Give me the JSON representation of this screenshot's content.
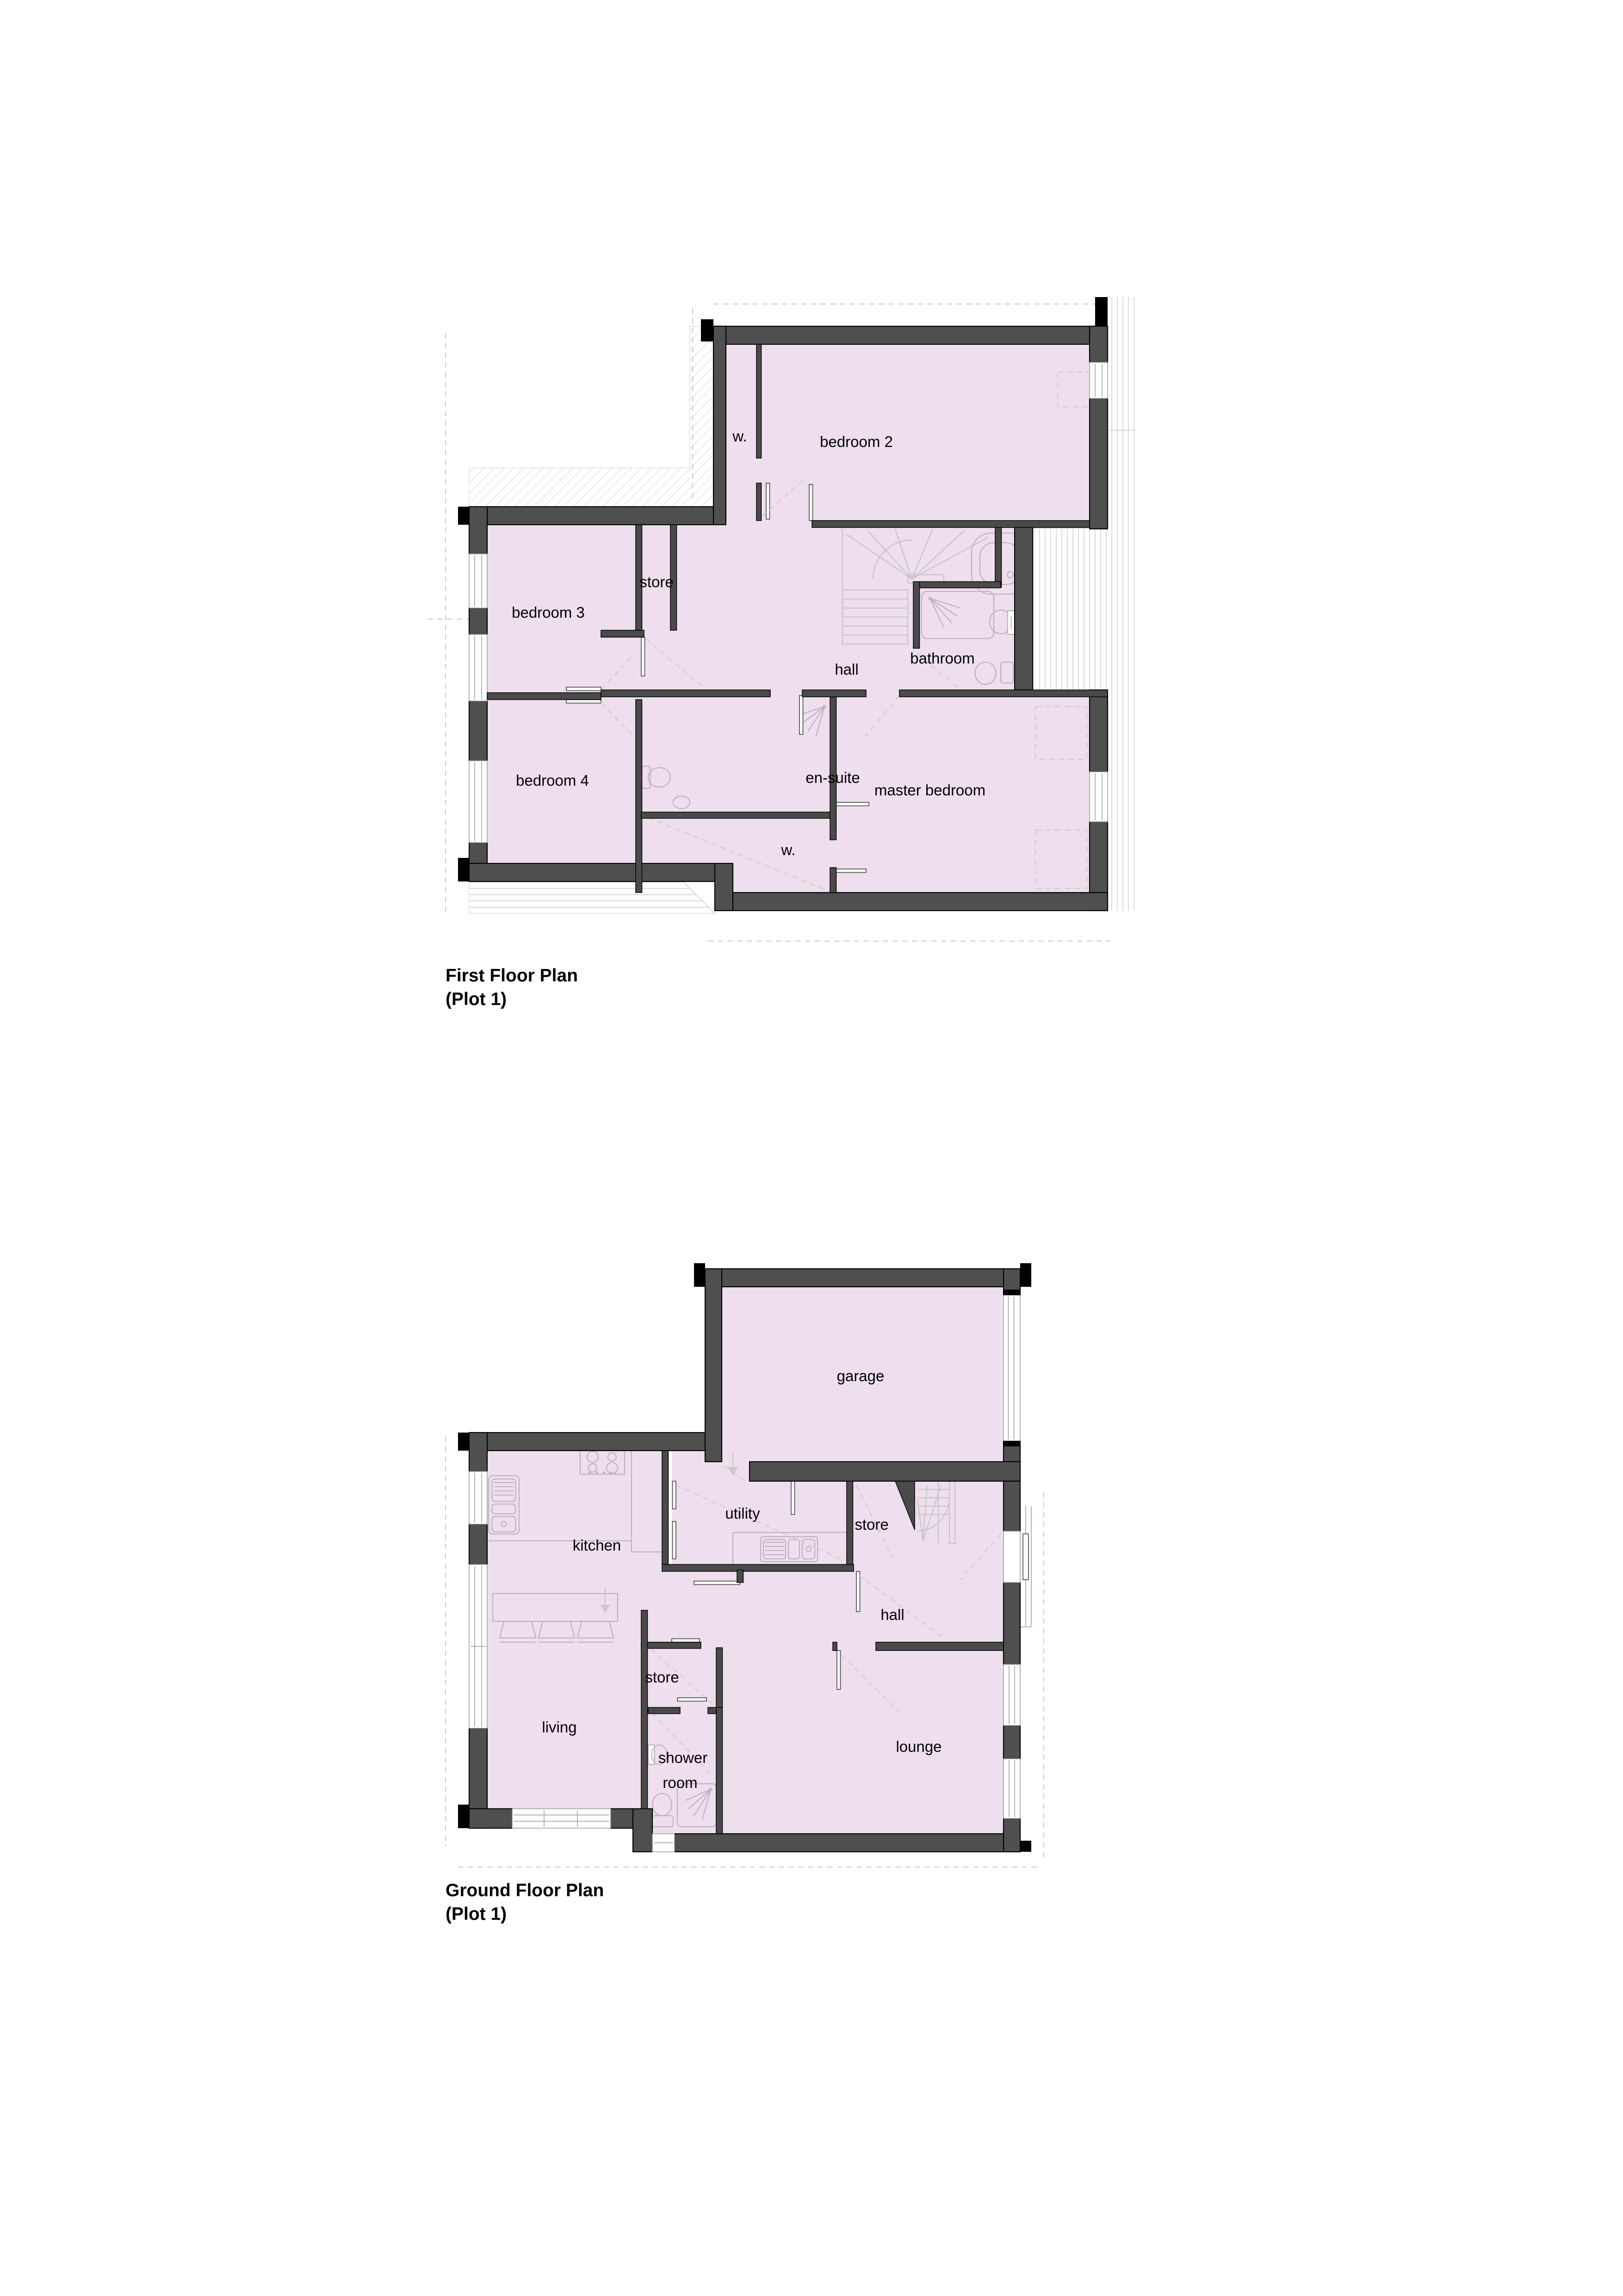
{
  "document": {
    "type": "architectural floor plan drawing",
    "plot": "Plot 1"
  },
  "first_floor": {
    "title": {
      "line1": "First Floor Plan",
      "line2": "(Plot 1)"
    },
    "rooms": {
      "wardrobe_top": "w.",
      "bedroom2": "bedroom 2",
      "store": "store",
      "hall": "hall",
      "bathroom": "bathroom",
      "bedroom3": "bedroom 3",
      "bedroom4": "bedroom 4",
      "ensuite": "en-suite",
      "master_bedroom": "master bedroom",
      "wardrobe_bottom": "w."
    }
  },
  "ground_floor": {
    "title": {
      "line1": "Ground Floor Plan",
      "line2": "(Plot 1)"
    },
    "rooms": {
      "garage": "garage",
      "utility": "utility",
      "kitchen": "kitchen",
      "store_upper": "store",
      "hall": "hall",
      "store_lower": "store",
      "living": "living",
      "shower_line1": "shower",
      "shower_line2": "room",
      "lounge": "lounge"
    }
  },
  "colors": {
    "wall": "#4f4f4f",
    "wall_interior": "#4a4a4a",
    "wall_edge": "#000000",
    "room_fill": "#efdeee",
    "fixture_line": "#bfaebd",
    "stair_line": "#c4c4c4",
    "dashed_line": "#cccccc",
    "roof_line": "#d6d6d6"
  }
}
